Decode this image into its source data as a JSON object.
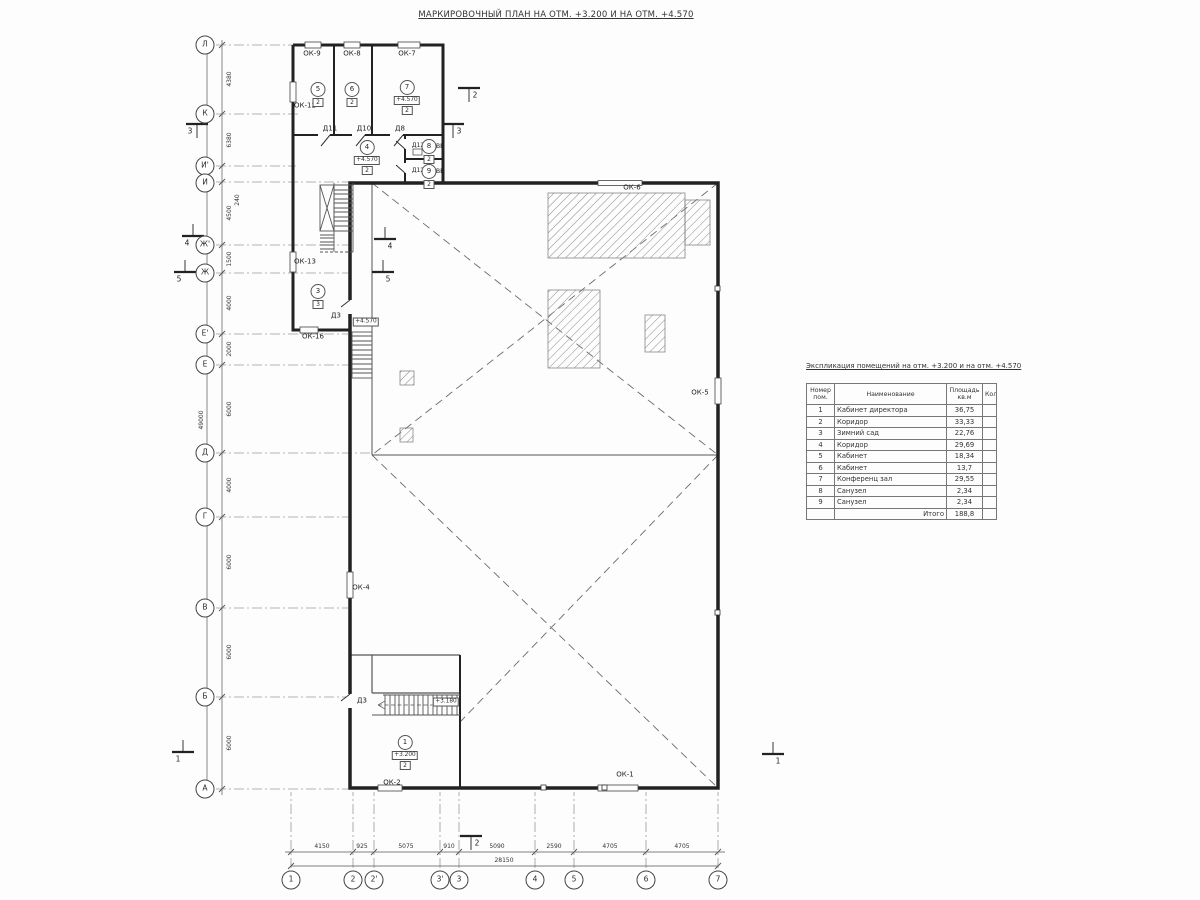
{
  "title": "МАРКИРОВОЧНЫЙ ПЛАН НА ОТМ. +3.200 И НА ОТМ. +4.570",
  "schedule": {
    "title": "Экспликация помещений на отм. +3.200 и на отм. +4.570",
    "columns": {
      "num": "Номер пом.",
      "name": "Наименование",
      "area": "Площадь кв.м",
      "qty": "Кол."
    },
    "rows": [
      {
        "num": "1",
        "name": "Кабинет директора",
        "area": "36,75"
      },
      {
        "num": "2",
        "name": "Коридор",
        "area": "33,33"
      },
      {
        "num": "3",
        "name": "Зимний сад",
        "area": "22,76"
      },
      {
        "num": "4",
        "name": "Коридор",
        "area": "29,69"
      },
      {
        "num": "5",
        "name": "Кабинет",
        "area": "18,34"
      },
      {
        "num": "6",
        "name": "Кабинет",
        "area": "13,7"
      },
      {
        "num": "7",
        "name": "Конференц зал",
        "area": "29,55"
      },
      {
        "num": "8",
        "name": "Санузел",
        "area": "2,34"
      },
      {
        "num": "9",
        "name": "Санузел",
        "area": "2,34"
      }
    ],
    "total_label": "Итого",
    "total_area": "188,8"
  },
  "axes": {
    "letters": [
      "Л",
      "К",
      "И'",
      "И",
      "Ж'",
      "Ж",
      "Е'",
      "Е",
      "Д",
      "Г",
      "В",
      "Б",
      "А"
    ],
    "numbers": [
      "1",
      "2",
      "2'",
      "3'",
      "3",
      "4",
      "5",
      "6",
      "7"
    ]
  },
  "dims": {
    "left": [
      "4380",
      "6380",
      "240",
      "4500",
      "1500",
      "4000",
      "2000",
      "6000",
      "4000",
      "6000",
      "6000",
      "6000"
    ],
    "left_total": "49000",
    "bottom": [
      "4150",
      "925",
      "5075",
      "910",
      "5090",
      "2590",
      "4705",
      "4705"
    ],
    "bottom_total": "28150"
  },
  "labels": {
    "ok1": "ОК-1",
    "ok2": "ОК-2",
    "ok4": "ОК-4",
    "ok5": "ОК-5",
    "ok6": "ОК-6",
    "ok7": "ОК-7",
    "ok8": "ОК-8",
    "ok9": "ОК-9",
    "ok12": "ОК-12",
    "ok13": "ОК-13",
    "ok16": "ОК-16",
    "d3_mid": "Д3",
    "d3_bottom": "Д3",
    "d8": "Д8",
    "d10": "Д10",
    "d11": "Д11",
    "d12_a": "Д12",
    "d12_b": "Д12",
    "ve_a": "ВЕ",
    "ve_b": "ВЕ"
  },
  "rooms": [
    {
      "num": "5",
      "box": "2"
    },
    {
      "num": "6",
      "box": "2"
    },
    {
      "num": "7",
      "elev": "+4.570",
      "box": "2"
    },
    {
      "num": "4",
      "elev": "+4.570",
      "box": "2"
    },
    {
      "num": "8",
      "box": "2"
    },
    {
      "num": "9",
      "box": "2"
    },
    {
      "num": "3",
      "box": "3"
    },
    {
      "num": "1",
      "elev": "+3.200",
      "box": "2"
    }
  ],
  "elevations": {
    "stair_mid": "+4.570",
    "stair_bottom": "+3.180"
  },
  "sections": {
    "s1_left": "1",
    "s1_right": "1",
    "s2_top": "2",
    "s2_bottom": "2",
    "s3_left": "3",
    "s3_right": "3",
    "s4_left": "4",
    "s4_right": "4",
    "s5_left": "5",
    "s5_right": "5"
  },
  "colors": {
    "line": "#2b2b2b",
    "thin": "#555555",
    "hatch": "#8a8a8a",
    "background": "#fdfdfd"
  }
}
